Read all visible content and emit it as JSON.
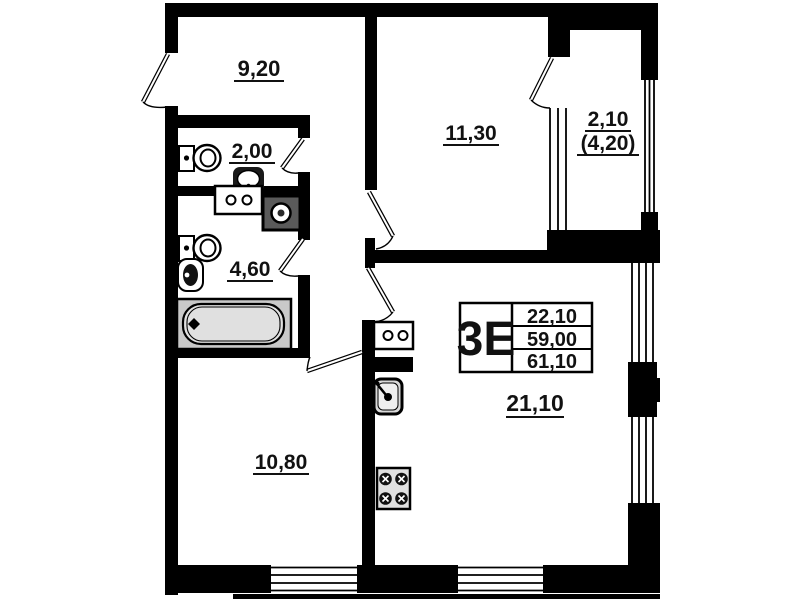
{
  "floor_plan": {
    "info_table": {
      "type_label": "3Е",
      "rows": [
        "22,10",
        "59,00",
        "61,10"
      ]
    },
    "rooms": [
      {
        "name": "hallway",
        "area_label": "9,20"
      },
      {
        "name": "wc",
        "area_label": "2,00"
      },
      {
        "name": "bathroom",
        "area_label": "4,60"
      },
      {
        "name": "room-upper",
        "area_label": "11,30"
      },
      {
        "name": "balcony",
        "area_label": "2,10",
        "area_label_secondary": "(4,20)"
      },
      {
        "name": "room-lower",
        "area_label": "10,80"
      },
      {
        "name": "kitchen-living-room",
        "area_label": "21,10"
      }
    ],
    "colors": {
      "wall": "#000000",
      "background": "#ffffff",
      "fixture_gray": "#cccccc"
    }
  }
}
